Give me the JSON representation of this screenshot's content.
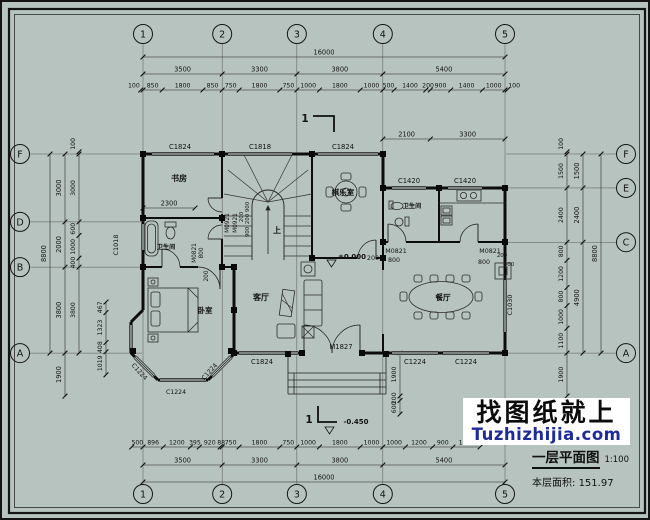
{
  "colors": {
    "background": "#b6c3bf",
    "line": "#141414",
    "watermark_blue": "#1e2b9b",
    "watermark_bg": "#ffffff"
  },
  "grid": {
    "cols": [
      "1",
      "2",
      "3",
      "4",
      "5"
    ],
    "rows_left": [
      "F",
      "D",
      "B",
      "A"
    ],
    "rows_right": [
      "F",
      "E",
      "C",
      "A"
    ]
  },
  "dims": {
    "top": {
      "total": "16000",
      "spans": [
        "3500",
        "3300",
        "3800",
        "5400"
      ],
      "details": [
        "100",
        "850",
        "1800",
        "850",
        "750",
        "1800",
        "750",
        "1000",
        "1800",
        "1000",
        "500",
        "1400",
        "200",
        "900",
        "1400",
        "1000",
        "100"
      ],
      "sub": [
        "2100",
        "3300"
      ]
    },
    "bottom": {
      "total": "16000",
      "spans": [
        "3500",
        "3300",
        "3800",
        "5400"
      ],
      "details": [
        "500",
        "896",
        "1200",
        "395",
        "920",
        "88",
        "750",
        "1800",
        "750",
        "1000",
        "1800",
        "1000",
        "1000",
        "1200",
        "900",
        "1200"
      ]
    },
    "left": {
      "total": "8800",
      "spans": [
        "3000",
        "2000",
        "3800",
        "1900"
      ],
      "details": [
        "100",
        "3000",
        "600",
        "1000",
        "400",
        "3800"
      ],
      "bay": [
        "467",
        "1323",
        "408",
        "1019"
      ]
    },
    "right": {
      "total": "8800",
      "spans": [
        "1500",
        "2400",
        "4900"
      ],
      "details": [
        "100",
        "1500",
        "2400",
        "800",
        "1200",
        "800",
        "1000",
        "1100",
        "1900"
      ]
    },
    "study_width": "2300",
    "porch": [
      "1900",
      "200",
      "600"
    ]
  },
  "ann": {
    "win_c1824_top_study": "C1824",
    "win_c1818_top_stair": "C1818",
    "win_c1824_top_game": "C1824",
    "win_c1420_bath": "C1420",
    "win_c1420_kitchen": "C1420",
    "win_c1018_left": "C1018",
    "win_c1030_right": "C1030",
    "win_c1824_bottom_living": "C1824",
    "win_c1224_bottom_d1": "C1224",
    "win_c1224_bottom_d2": "C1224",
    "win_c1224_bay_left": "C1224",
    "win_c1224_bay_bottom": "C1224",
    "win_c1224_bay_right": "C1224",
    "door_m1827": "M1827",
    "door_m0821_bath": "M0821",
    "dim_800_bath": "800",
    "door_m0821_kitchen": "M0821",
    "dim_800_kitchen": "800",
    "dim_200_kitchen": "200",
    "dim_400_kitchen": "400",
    "door_m0921_a": "M0921",
    "door_m0921_b": "M0921",
    "dim_200_stair": "200",
    "dim_900_a": "900",
    "dim_200_mid": "200",
    "dim_900_b": "900",
    "door_m0821_bath_left": "M0821",
    "dim_800_bath_left": "800",
    "dim_200_bed": "200",
    "dim_200_entry": "200"
  },
  "rooms": {
    "study": "书房",
    "game": "棋乐室",
    "bath_right": "卫生间",
    "bath_left": "卫生间",
    "bedroom": "卧室",
    "living": "客厅",
    "dining": "餐厅"
  },
  "levels": {
    "main": "±0.000",
    "porch": "-0.450"
  },
  "sections": {
    "top": "1",
    "bottom": "1"
  },
  "stair": {
    "up": "上"
  },
  "watermark": {
    "title": "找图纸就上",
    "site": "Tuzhizhijia.com"
  },
  "title_block": {
    "name": "一层平面图",
    "scale": "1:100",
    "area_label": "本层面积:",
    "area_value": "151.97"
  }
}
